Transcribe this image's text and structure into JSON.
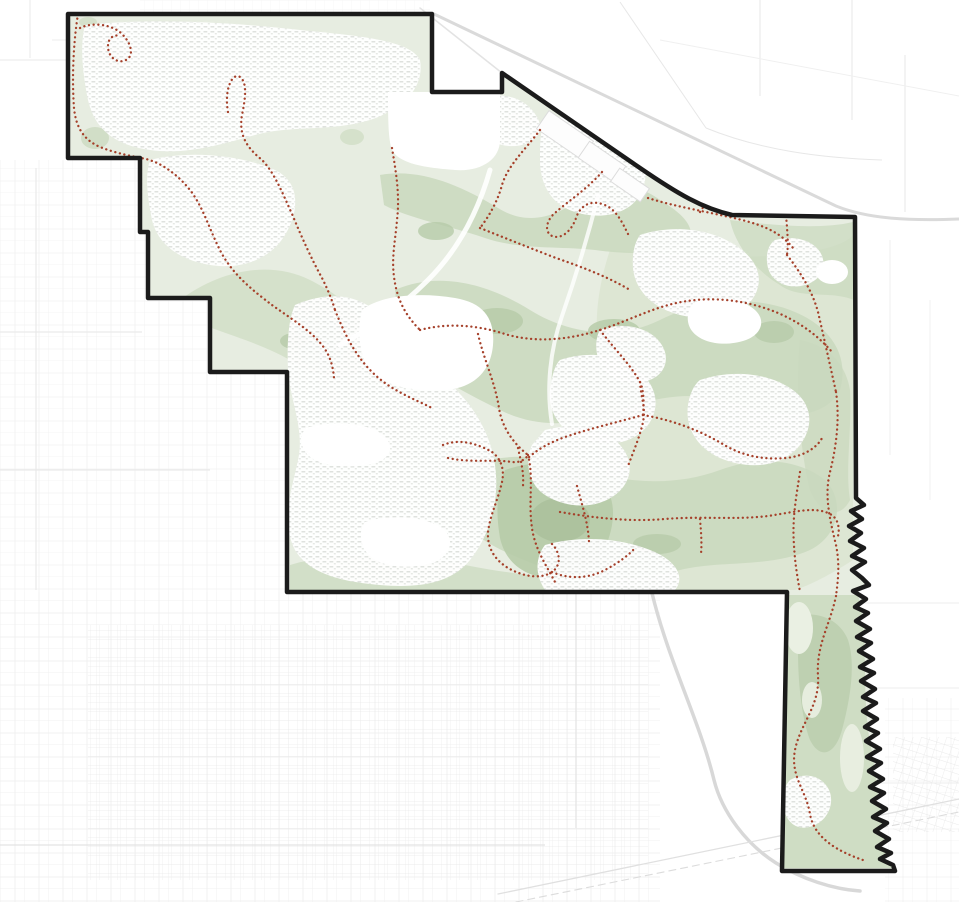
{
  "page": {
    "kind": "trails-and-open-space-map",
    "background": "#ffffff"
  },
  "map": {
    "width": 959,
    "height": 902,
    "palette": {
      "boundary": "#1b1b1b",
      "base_green": "#e7ede1",
      "medium_green": "#c9d8bd",
      "soft_green": "#d5e0c9",
      "dark_green": "#b7cba9",
      "darkest_green": "#aabf9b",
      "light_patch": "#eaf0e3",
      "trail_red": "#a5402a",
      "outside_road": "#d9d9d9",
      "outside_grid": "#e8e8e8",
      "resi_texture": "#dfe2de",
      "resi_texture2": "#e3e6e2",
      "parcel_stroke": "#dcdcdc",
      "white": "#ffffff"
    },
    "boundary": {
      "d": "M 68,14 L 432,14 L 432,92 L 502,92 L 502,73 L 640,168 C 678,194 702,208 732,215 L 855,217 L 856,498 L 864,505 L 851,511 L 862,519 L 849,526 L 861,533 L 850,541 L 864,548 L 852,556 L 865,562 L 852,570 L 862,578 L 869,585 L 853,591 L 866,599 L 855,607 L 868,613 L 856,621 L 870,629 L 857,637 L 871,643 L 859,651 L 873,659 L 860,667 L 874,673 L 861,681 L 875,689 L 863,697 L 876,703 L 863,711 L 877,719 L 865,727 L 878,733 L 866,741 L 880,749 L 867,757 L 881,763 L 869,771 L 883,779 L 870,787 L 884,793 L 872,801 L 886,809 L 873,817 L 887,823 L 875,831 L 889,839 L 877,847 L 891,853 L 880,859 L 893,865 L 895,871 L 782,871 L 787,592 L 287,592 L 287,372 L 210,372 L 210,298 L 148,298 L 148,232 L 140,232 L 140,158 L 68,158 Z",
      "stroke_width": 4.5
    },
    "outside": {
      "grids": [
        {
          "rect": [
            0,
            160,
            286,
            432
          ],
          "pattern": "p-sparse",
          "opacity": 0.75
        },
        {
          "rect": [
            0,
            592,
            660,
            310
          ],
          "pattern": "p-sparse",
          "opacity": 0.85
        },
        {
          "rect": [
            88,
            625,
            560,
            255
          ],
          "pattern": "p-fine",
          "opacity": 0.9
        },
        {
          "rect": [
            885,
            698,
            74,
            204
          ],
          "pattern": "p-sparse",
          "opacity": 0.7
        },
        {
          "rect": [
            893,
            737,
            66,
            95
          ],
          "pattern": "p-rot",
          "opacity": 0.95
        },
        {
          "rect": [
            140,
            0,
            290,
            13
          ],
          "pattern": "p-fine",
          "opacity": 0.5
        }
      ],
      "lines": [
        {
          "d": "M 36,168 L 36,590",
          "stroke": "#e6e6e6",
          "width": 1
        },
        {
          "d": "M 0,332 L 142,332",
          "stroke": "#e6e6e6",
          "width": 1
        },
        {
          "d": "M 0,470 L 210,470",
          "stroke": "#e6e6e6",
          "width": 1
        },
        {
          "d": "M 576,594 L 576,828",
          "stroke": "#e3e3e3",
          "width": 1.2
        },
        {
          "d": "M 0,845 L 545,845",
          "stroke": "#e3e3e3",
          "width": 1.2
        },
        {
          "d": "M 862,603 L 959,603",
          "stroke": "#ededed",
          "width": 1
        },
        {
          "d": "M 870,688 L 959,688",
          "stroke": "#ededed",
          "width": 1
        },
        {
          "d": "M 878,783 L 959,783",
          "stroke": "#ededed",
          "width": 1
        },
        {
          "d": "M 620,2 L 706,128",
          "stroke": "#e7e7e7",
          "width": 1
        },
        {
          "d": "M 706,128 C 760,150 820,158 882,160",
          "stroke": "#e7e7e7",
          "width": 1
        },
        {
          "d": "M 760,0 L 760,96",
          "stroke": "#e7e7e7",
          "width": 1
        },
        {
          "d": "M 852,0 L 852,120",
          "stroke": "#e7e7e7",
          "width": 1
        },
        {
          "d": "M 905,55 L 905,212",
          "stroke": "#e7e7e7",
          "width": 1
        },
        {
          "d": "M 890,240 L 890,455",
          "stroke": "#efefef",
          "width": 1
        },
        {
          "d": "M 930,300 L 930,500",
          "stroke": "#f1f1f1",
          "width": 1
        },
        {
          "d": "M 0,60 L 66,60",
          "stroke": "#e9e9e9",
          "width": 1
        },
        {
          "d": "M 30,0 L 30,58",
          "stroke": "#e9e9e9",
          "width": 1
        },
        {
          "d": "M 52,40 L 68,40",
          "stroke": "#ededed",
          "width": 1
        },
        {
          "d": "M 660,40 L 959,96",
          "stroke": "#f0f0f0",
          "width": 1
        }
      ],
      "roads": [
        {
          "d": "M 434,14 L 836,206 C 868,219 910,221 959,219",
          "stroke": "#dadada",
          "width": 3
        },
        {
          "d": "M 420,8 L 502,73",
          "stroke": "#e3e3e3",
          "width": 1.5
        },
        {
          "d": "M 652,593 C 668,660 700,722 714,780 C 722,812 746,844 776,863 C 802,879 832,889 860,891",
          "stroke": "#d8d8d8",
          "width": 3.5
        },
        {
          "d": "M 498,894 L 959,799",
          "stroke": "#e0e0e0",
          "width": 1.3
        },
        {
          "d": "M 516,902 L 959,812",
          "stroke": "#dcdcdc",
          "width": 1.1,
          "dash": "7 5"
        }
      ]
    },
    "city": {
      "greenbelts": [
        {
          "d": "M 610,250 C 660,255 720,260 780,255 C 820,252 845,245 853,235 L 853,560 C 830,575 810,585 795,590 L 620,590 C 600,560 595,520 605,480 C 615,440 610,400 600,360 C 592,320 600,280 610,250 Z",
          "fill": "#d5e0c9",
          "opacity": 0.55
        },
        {
          "d": "M 380,175 C 420,168 460,185 498,208 C 530,228 560,215 585,195 C 610,178 640,185 660,200 C 680,212 695,225 690,240 C 670,255 630,255 595,250 C 560,246 520,250 485,238 C 450,226 408,218 384,205 Z",
          "fill": "#c9d8bd",
          "opacity": 0.85
        },
        {
          "d": "M 180,300 C 220,270 270,260 310,280 C 350,300 380,330 370,360 C 355,385 320,380 290,360 C 255,340 210,330 180,315 Z",
          "fill": "#c9d8bd",
          "opacity": 0.6
        },
        {
          "d": "M 395,290 C 440,270 490,285 530,310 C 570,335 620,340 660,320 C 700,300 750,295 790,310 C 830,325 850,355 840,390 C 825,420 780,420 740,405 C 700,390 660,395 620,410 C 580,425 540,430 500,410 C 460,390 420,370 400,340 Z",
          "fill": "#c9d8bd",
          "opacity": 0.85
        },
        {
          "d": "M 460,470 C 500,450 550,455 590,470 C 630,485 680,485 720,470 C 760,455 800,460 825,480 C 845,500 840,535 810,550 C 770,568 720,560 680,570 C 640,580 590,585 550,570 C 510,555 470,540 455,510 Z",
          "fill": "#c9d8bd",
          "opacity": 0.85
        },
        {
          "d": "M 780,595 L 858,595 C 870,640 860,700 872,752 C 880,802 882,842 893,868 L 780,868 Z",
          "fill": "#c9d8bd",
          "opacity": 0.8
        },
        {
          "d": "M 730,220 C 770,225 820,230 853,222 L 854,300 C 830,290 800,300 780,285 C 755,270 735,245 730,220 Z",
          "fill": "#c9d8bd",
          "opacity": 0.7
        },
        {
          "d": "M 800,340 C 825,345 845,360 850,390 C 852,430 845,470 850,500 C 840,520 820,515 810,490 C 800,450 795,390 800,340 Z",
          "fill": "#c9d8bd",
          "opacity": 0.75
        },
        {
          "d": "M 300,320 C 320,310 340,320 345,340 C 348,360 335,375 315,370 C 298,364 292,335 300,320 Z",
          "fill": "#c9d8bd",
          "opacity": 0.8
        },
        {
          "d": "M 290,565 C 345,548 420,556 470,566 C 520,576 560,576 592,588 L 592,600 L 290,600 Z",
          "fill": "#c9d8bd",
          "opacity": 0.7
        },
        {
          "ellipse": [
            107,
            57,
            22,
            12
          ],
          "fill": "#c9d8bd",
          "opacity": 0.7
        },
        {
          "ellipse": [
            95,
            138,
            14,
            11
          ],
          "fill": "#c9d8bd",
          "opacity": 0.75
        },
        {
          "ellipse": [
            212,
            98,
            16,
            9
          ],
          "fill": "#c9d8bd",
          "opacity": 0.6
        },
        {
          "ellipse": [
            303,
            83,
            14,
            8
          ],
          "fill": "#c9d8bd",
          "opacity": 0.6
        },
        {
          "ellipse": [
            352,
            137,
            12,
            8
          ],
          "fill": "#c9d8bd",
          "opacity": 0.6
        },
        {
          "ellipse": [
            520,
            120,
            14,
            8
          ],
          "fill": "#c9d8bd",
          "opacity": 0.5
        },
        {
          "ellipse": [
            88,
            22,
            9,
            5
          ],
          "fill": "#c9d8bd",
          "opacity": 0.6
        }
      ],
      "accents": [
        {
          "ellipse": [
            497,
            321,
            26,
            13
          ],
          "fill": "#b7cba9",
          "opacity": 0.85
        },
        {
          "ellipse": [
            614,
            331,
            26,
            12
          ],
          "fill": "#b7cba9",
          "opacity": 0.85
        },
        {
          "ellipse": [
            774,
            332,
            20,
            11
          ],
          "fill": "#b7cba9",
          "opacity": 0.8
        },
        {
          "ellipse": [
            436,
            231,
            18,
            9
          ],
          "fill": "#b7cba9",
          "opacity": 0.8
        },
        {
          "ellipse": [
            294,
            341,
            14,
            8
          ],
          "fill": "#b7cba9",
          "opacity": 0.8
        },
        {
          "d": "M 505,470 C 540,458 580,462 600,480 C 618,498 615,525 605,548 C 595,570 570,582 545,578 C 520,574 505,560 500,538 C 496,515 496,490 505,470 Z",
          "fill": "#b7cba9",
          "opacity": 0.9
        },
        {
          "ellipse": [
            560,
            520,
            30,
            22
          ],
          "fill": "#aabf9b",
          "opacity": 0.8
        },
        {
          "d": "M 800,615 C 820,612 840,620 848,640 C 856,665 850,700 842,730 C 835,755 820,760 810,740 C 800,715 795,660 800,615 Z",
          "fill": "#b7cba9",
          "opacity": 0.7
        },
        {
          "ellipse": [
            657,
            544,
            24,
            10
          ],
          "fill": "#b7cba9",
          "opacity": 0.8
        }
      ],
      "light_patches": [
        {
          "ellipse": [
            799,
            628,
            14,
            26
          ],
          "fill": "#eaf0e3",
          "opacity": 1
        },
        {
          "ellipse": [
            852,
            758,
            12,
            34
          ],
          "fill": "#eaf0e3",
          "opacity": 0.9
        },
        {
          "ellipse": [
            812,
            700,
            10,
            18
          ],
          "fill": "#eaf0e3",
          "opacity": 0.9
        }
      ],
      "residential": [
        {
          "d": "M 85,25 C 150,18 230,22 300,30 C 360,36 410,40 420,60 C 425,90 400,110 370,120 C 330,132 290,125 255,135 C 220,145 185,155 150,150 C 115,145 95,130 88,100 C 82,70 80,45 85,25 Z"
        },
        {
          "d": "M 150,160 C 190,150 240,155 275,170 C 300,182 300,210 285,235 C 270,260 240,270 210,265 C 180,260 158,245 152,220 C 147,195 145,175 150,160 Z"
        },
        {
          "d": "M 295,305 C 330,290 360,295 380,315 C 400,335 420,360 445,380 C 470,400 490,430 495,465 C 500,500 490,535 470,560 C 450,585 415,588 380,585 C 345,582 310,575 295,550 C 280,520 292,490 298,460 C 305,430 290,400 288,370 C 287,345 288,320 295,305 Z"
        },
        {
          "d": "M 478,98 C 500,92 520,96 532,110 C 544,124 542,135 530,142 C 514,150 494,146 482,134 C 472,122 472,106 478,98 Z"
        },
        {
          "d": "M 545,120 C 575,112 610,118 630,135 C 648,152 650,175 640,195 C 628,215 600,220 575,212 C 552,205 540,185 540,160 C 540,145 540,130 545,120 Z"
        },
        {
          "d": "M 640,235 C 670,225 705,228 730,242 C 755,256 765,275 755,295 C 742,318 710,322 680,315 C 652,308 635,290 633,268 C 632,252 635,242 640,235 Z"
        },
        {
          "d": "M 700,380 C 730,370 765,372 790,388 C 812,402 815,425 800,445 C 782,468 748,470 720,458 C 695,447 685,425 688,405 C 690,392 695,384 700,380 Z"
        },
        {
          "d": "M 560,360 C 590,350 620,355 640,372 C 658,388 660,408 648,425 C 633,445 605,448 580,438 C 558,429 548,410 550,390 C 552,375 555,365 560,360 Z"
        },
        {
          "d": "M 545,430 C 575,422 605,428 620,445 C 635,462 632,482 615,495 C 595,510 565,508 545,495 C 527,483 525,460 532,445 Z"
        },
        {
          "d": "M 545,545 C 580,535 620,538 650,550 C 678,561 685,578 675,590 L 545,590 C 535,575 535,558 545,545 Z"
        },
        {
          "d": "M 790,780 C 805,772 820,775 828,788 C 835,800 830,818 815,825 C 800,832 788,825 784,810 C 781,797 783,788 790,780 Z"
        },
        {
          "d": "M 775,240 C 795,235 812,240 820,252 C 828,265 822,280 805,285 C 788,290 772,282 768,268 C 765,255 768,245 775,240 Z"
        },
        {
          "d": "M 600,330 C 620,322 645,326 658,340 C 670,353 668,370 654,378 C 638,387 615,384 604,370 C 595,358 594,340 600,330 Z"
        }
      ],
      "plain_areas": [
        {
          "d": "M 388,92 L 500,92 L 500,140 C 500,160 480,172 455,170 C 430,168 400,165 392,150 C 388,140 388,115 388,92 Z"
        },
        {
          "d": "M 362,310 C 380,295 420,292 455,298 C 485,303 495,320 493,345 C 491,370 475,388 445,390 C 410,392 375,385 365,362 C 358,345 358,325 362,310 Z"
        },
        {
          "d": "M 306,428 C 330,420 365,422 382,434 C 395,444 392,458 375,463 C 352,469 320,467 308,455 C 299,446 300,434 306,428 Z"
        },
        {
          "d": "M 365,522 C 390,514 425,516 442,528 C 455,538 452,554 435,562 C 412,570 380,568 368,554 C 359,544 359,530 365,522 Z"
        },
        {
          "d": "M 695,302 C 715,296 742,298 755,310 C 766,320 762,334 746,340 C 726,347 702,344 692,331 C 685,322 687,308 695,302 Z"
        },
        {
          "ellipse": [
            832,
            272,
            16,
            12
          ]
        }
      ],
      "parcels": [
        {
          "rect": [
            538,
            124,
            54,
            22
          ],
          "rotate": 34.5
        },
        {
          "rect": [
            580,
            152,
            44,
            20
          ],
          "rotate": 34.5
        },
        {
          "rect": [
            570,
            105,
            30,
            14
          ],
          "rotate": 34.5
        },
        {
          "rect": [
            612,
            177,
            36,
            16
          ],
          "rotate": 34.5
        }
      ],
      "inner_roads": [
        {
          "d": "M 490,170 C 478,212 458,250 428,280 C 398,310 368,330 340,345",
          "stroke": "#ffffff",
          "width": 5,
          "opacity": 0.9
        },
        {
          "d": "M 598,196 C 588,236 576,276 562,316 C 550,350 546,388 552,424",
          "stroke": "#ffffff",
          "width": 4,
          "opacity": 0.8
        }
      ],
      "trails": [
        {
          "d": "M 78,14 C 73,45 72,80 74,108 C 76,128 84,140 100,147 C 118,154 132,156 146,159 C 162,163 178,175 190,190 C 204,208 210,232 222,254 C 235,277 255,292 272,305 C 290,318 310,330 322,345 C 330,355 333,366 334,378"
        },
        {
          "d": "M 80,28 C 92,22 112,24 122,34 C 132,44 134,56 126,60 C 118,64 108,58 108,46 C 108,38 114,34 120,36"
        },
        {
          "d": "M 228,112 C 224,90 232,72 240,77 C 248,83 245,100 242,115 C 238,138 250,150 262,160 C 274,172 282,192 292,214 C 302,238 312,260 322,278 C 328,290 332,300 335,310"
        },
        {
          "d": "M 335,310 C 345,335 355,355 372,372 C 390,390 412,398 432,408"
        },
        {
          "d": "M 392,148 C 396,172 400,195 397,220 C 395,245 390,262 396,288 C 400,305 408,318 420,330"
        },
        {
          "d": "M 540,130 C 525,150 508,165 502,185 C 498,200 490,215 480,228"
        },
        {
          "d": "M 480,228 C 505,238 530,248 556,258 C 585,268 610,278 630,290"
        },
        {
          "d": "M 602,172 C 588,188 570,200 556,212 C 546,220 544,232 552,236 C 562,240 572,230 576,218 C 580,206 590,200 602,204 C 616,208 622,222 630,238"
        },
        {
          "d": "M 420,330 C 450,322 480,326 505,334 C 535,343 568,340 600,330 C 625,322 648,310 672,304 C 700,297 730,298 758,306 C 790,315 815,332 832,352"
        },
        {
          "d": "M 648,198 C 676,207 710,212 742,220 C 766,226 782,234 793,248"
        },
        {
          "d": "M 768,168 C 779,184 786,205 787,228 C 788,240 788,248 787,255"
        },
        {
          "d": "M 787,255 C 800,272 812,290 818,312 C 824,338 830,365 836,392"
        },
        {
          "d": "M 700,212 C 708,198 726,188 742,190 C 756,192 758,204 748,210"
        },
        {
          "d": "M 836,392 C 840,420 836,448 830,472 C 824,496 830,520 836,545 C 840,565 838,580 836,596"
        },
        {
          "d": "M 836,596 C 830,625 816,645 818,676 C 820,706 800,724 795,750 C 790,776 806,790 810,814 C 814,838 838,852 866,861"
        },
        {
          "d": "M 800,472 C 796,498 792,520 794,545 C 795,565 798,580 800,592"
        },
        {
          "d": "M 600,330 C 615,350 632,366 641,384 C 644,394 644,404 643,415"
        },
        {
          "d": "M 640,382 C 641,398 646,408 643,422 C 640,436 634,450 628,466"
        },
        {
          "d": "M 643,415 C 618,422 592,428 568,436 C 550,442 536,450 526,460"
        },
        {
          "d": "M 643,415 C 672,420 700,430 726,446 C 744,456 764,460 786,458 C 806,456 818,446 822,438"
        },
        {
          "d": "M 560,512 C 595,518 630,522 665,519 C 700,516 736,520 768,516 C 795,512 815,506 830,514 C 838,518 840,528 838,536"
        },
        {
          "d": "M 700,519 C 701,532 702,542 701,554"
        },
        {
          "d": "M 478,334 C 484,360 495,382 499,408 C 502,428 514,444 528,455"
        },
        {
          "d": "M 448,458 C 470,463 492,459 512,462 C 520,463 526,459 528,455"
        },
        {
          "d": "M 443,445 C 460,438 478,444 492,452 C 500,458 505,468 502,482 C 498,500 490,515 488,532 C 487,548 495,560 508,568 C 522,576 540,580 552,572 C 562,565 560,552 552,544"
        },
        {
          "d": "M 552,572 C 570,580 590,578 605,570 C 618,563 628,556 635,548"
        },
        {
          "d": "M 518,448 C 521,462 524,472 523,486"
        },
        {
          "d": "M 577,486 C 582,505 588,522 589,542"
        },
        {
          "d": "M 528,455 C 534,478 528,502 532,528 C 535,550 548,568 556,584"
        }
      ]
    }
  }
}
